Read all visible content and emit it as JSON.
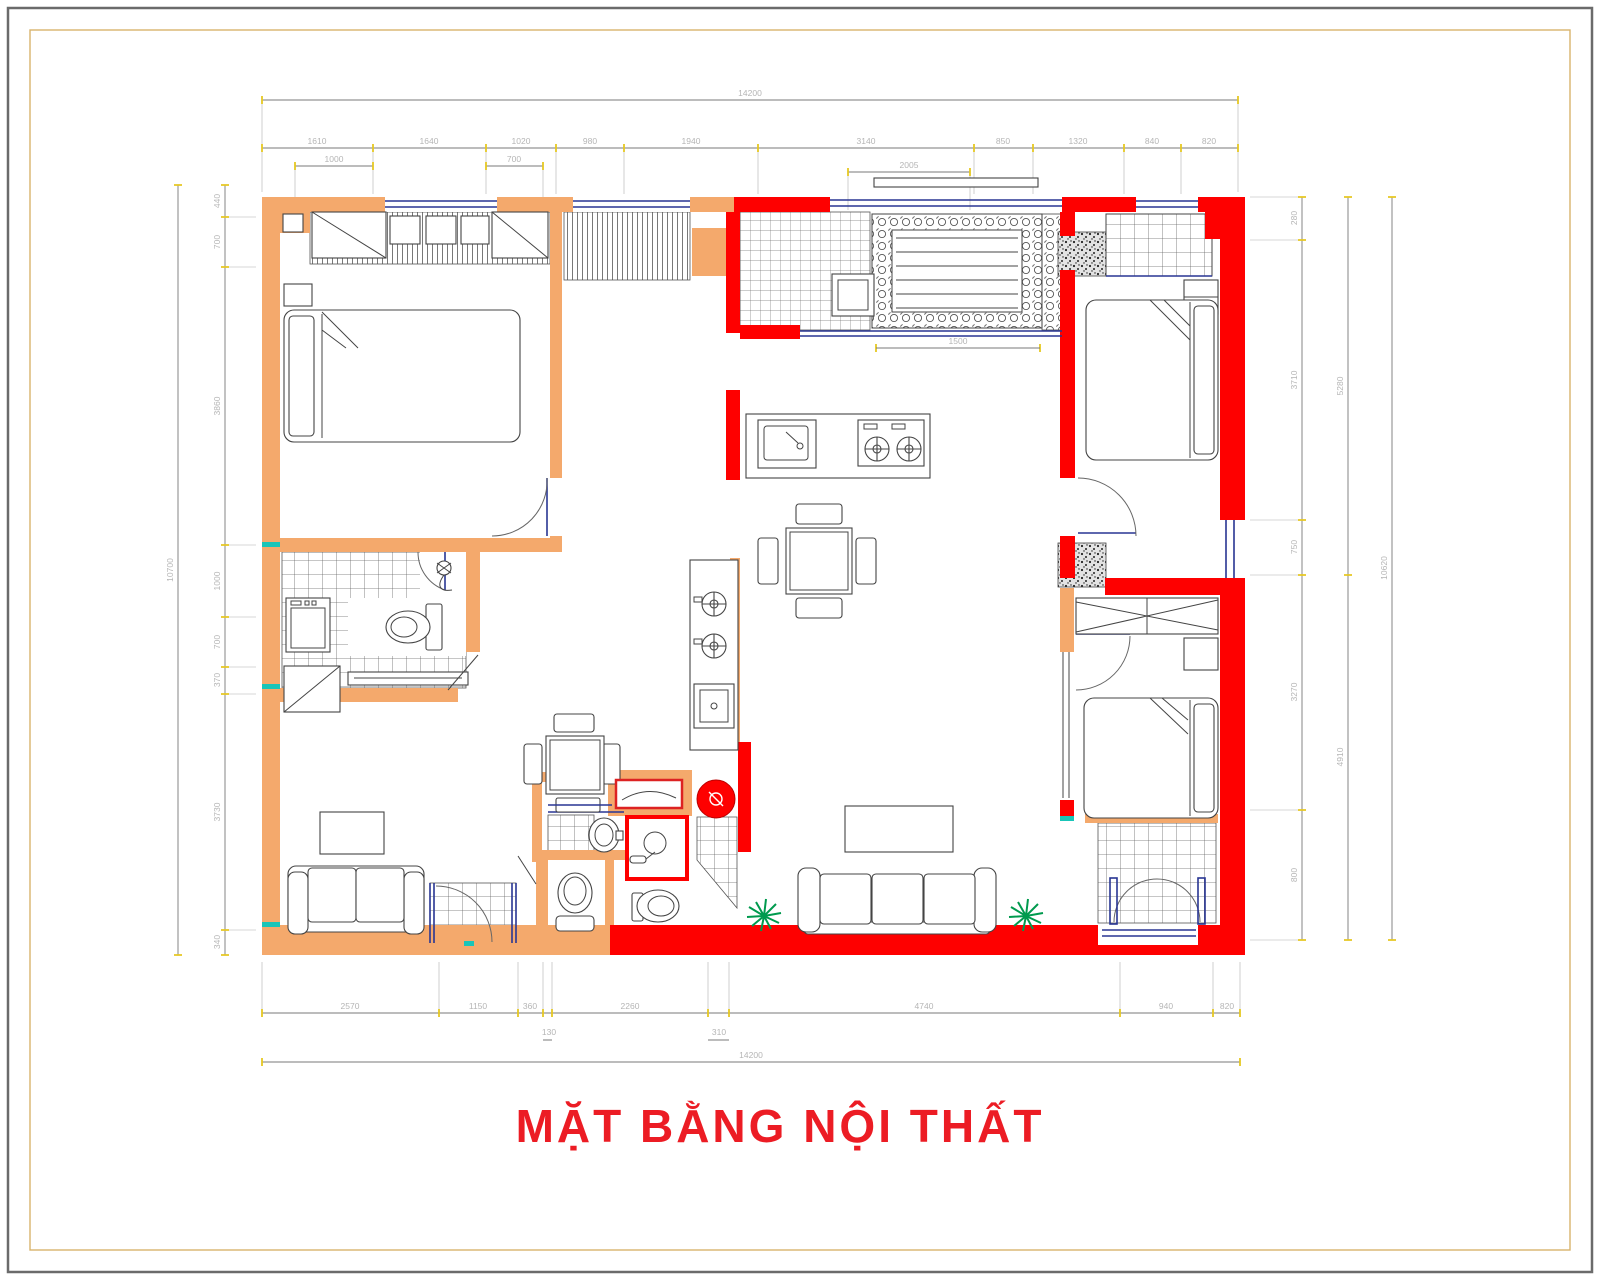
{
  "sheet": {
    "title": "MẶT BẰNG NỘI THẤT"
  },
  "colors": {
    "masonry_wall": "#F4A96C",
    "concrete_wall": "#FE0000",
    "dim_text": "#B5B5B5",
    "dim_line": "#787878",
    "tick": "#E6C822",
    "window_line": "#283593",
    "plant": "#009A4E",
    "accent_teal": "#19C5B8",
    "drawing_line": "#444444",
    "title_text": "#EC1C24",
    "inner_border": "#D9B36C",
    "outer_border": "#6B6B6B"
  },
  "dims": {
    "top_total": "14200",
    "top_row": [
      "1610",
      "1640",
      "1020",
      "980",
      "1940",
      "3140",
      "850",
      "1320",
      "840",
      "820"
    ],
    "top_sub": [
      "1000",
      "700",
      "2005"
    ],
    "balcony_width": "1500",
    "left_total": "10700",
    "left_col": [
      "440",
      "700",
      "3860",
      "1000",
      "700",
      "370",
      "3730",
      "340"
    ],
    "right_total": "10620",
    "right_col": [
      "280",
      "3710",
      "750",
      "3270",
      "800"
    ],
    "right_mid": [
      "5280",
      "4910"
    ],
    "bottom_row": [
      "2570",
      "1150",
      "360",
      "2260",
      "4740",
      "940",
      "820"
    ],
    "bottom_sub": [
      "130",
      "310"
    ],
    "bottom_total": "14200"
  }
}
